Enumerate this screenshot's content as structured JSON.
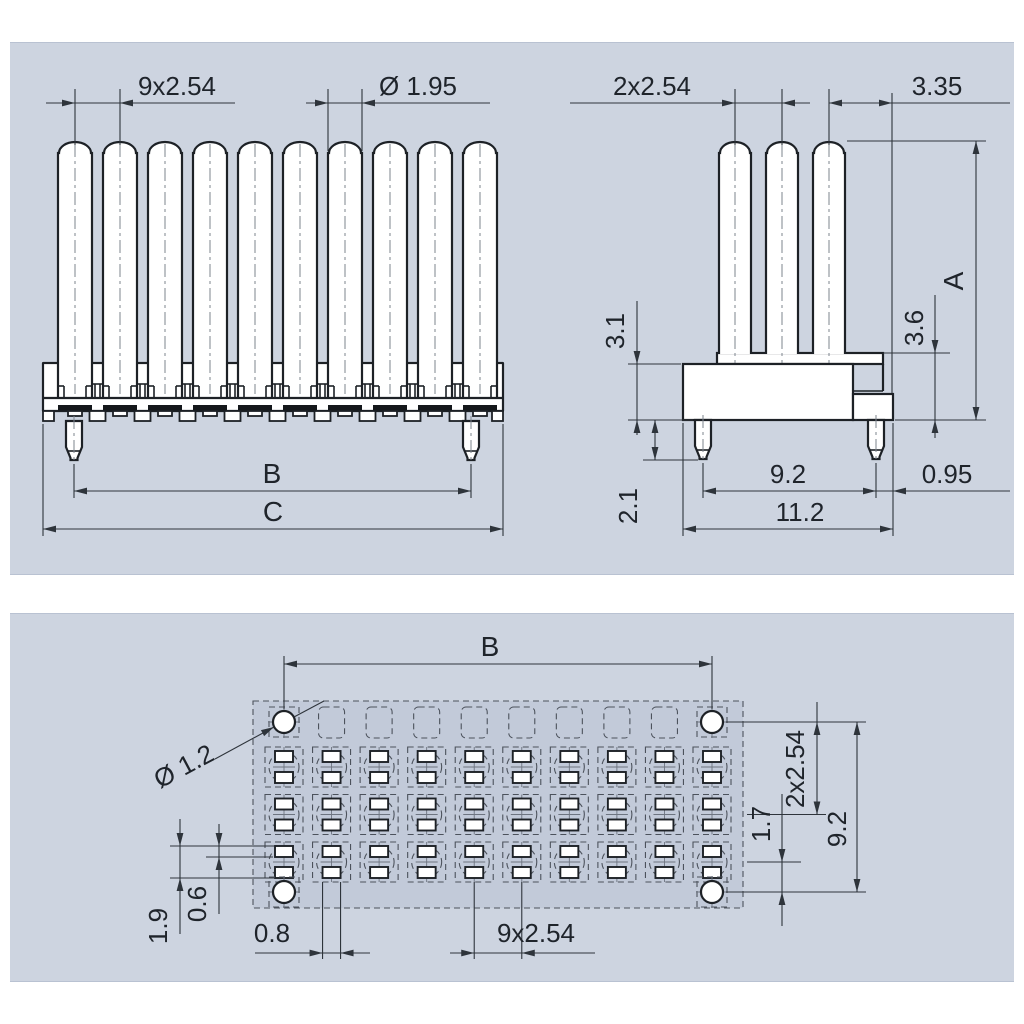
{
  "panels": {
    "front_view": {
      "pitch": "9x2.54",
      "pin_diameter": "Ø 1.95",
      "span_b": "B",
      "span_c": "C"
    },
    "side_view": {
      "pitch": "2x2.54",
      "pin_offset": "3.35",
      "height_a": "A",
      "insulator_height": "3.6",
      "body_height": "3.1",
      "peg_length": "2.1",
      "peg_span": "9.2",
      "edge_offset": "0.95",
      "body_width": "11.2"
    },
    "footprint": {
      "span_b": "B",
      "hole_diameter": "Ø 1.2",
      "row_span": "2x2.54",
      "row_gap": "1.7",
      "hole_row_span": "9.2",
      "pad_pair_height": "1.9",
      "pad_height": "0.6",
      "pad_width": "0.8",
      "column_pitch": "9x2.54"
    }
  },
  "structure": {
    "front_pin_count": 10,
    "side_pin_count": 3,
    "footprint_columns": 10,
    "footprint_pad_rows": 3
  },
  "colors": {
    "panel_bg": "#cdd4e0",
    "footprint_fill": "#c2cad9",
    "outline": "#1d2126",
    "dimension": "#2e343b"
  }
}
